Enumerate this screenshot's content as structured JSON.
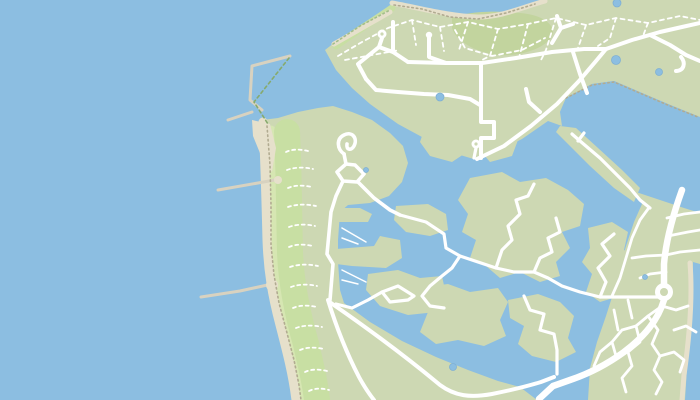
{
  "meta": {
    "kind": "map-tile",
    "description": "Coastal marina map with breakwater harbour, dune beach strip, headland road network and marina island estate",
    "width": 700,
    "height": 400
  },
  "map": {
    "palette": {
      "water": "#8cbee1",
      "pond": "#8cbee1",
      "pondEdge": "#7fb0d4",
      "land": "#cdd8b3",
      "duneLight": "#d6e6b2",
      "duneMid": "#c8dfa3",
      "scrub": "#c2d49e",
      "sand": "#e6e0cb",
      "sandPier": "#d8d2c0",
      "road": "#ffffff",
      "trail": "#ffffff",
      "dotTan": "#b1ab91",
      "dotGreen": "#a3bd8a",
      "dashGreen": "#86aa6d"
    },
    "layers": [
      {
        "name": "sea-base",
        "fill": "water",
        "paths": [
          "M0,0 H700 V400 H0 Z"
        ]
      },
      {
        "name": "headland-land",
        "fill": "land",
        "paths": [
          "M545,0 L700,0 L700,117 L668,104 L642,93 L614,81 L592,84 L566,98 L560,112 L562,126 L548,121 L522,139 L498,151 L477,160 L450,152 L422,137 L398,124 L370,104 L352,88 L336,70 L325,50 L334,43 L362,25 L392,4 L420,7 L450,15 L478,17 L508,11 L535,2 Z"
        ]
      },
      {
        "name": "coastal-strip-land",
        "fill": "land",
        "paths": [
          "M262,120 L278,118 L298,112 L318,108 L333,106 L352,112 L372,120 L390,133 L403,146 L408,163 L402,182 L389,196 L370,203 L348,205 L340,212 L338,240 L338,262 L340,290 L344,303 L370,322 L402,341 L436,357 L468,370 L498,381 L520,387 L537,400 L300,400 L296,372 L288,345 L281,318 L276,294 L272,268 L270,238 L268,200 L266,162 L263,138 Z"
        ]
      },
      {
        "name": "urban-land",
        "fill": "land",
        "paths": [
          "M642,204 L636,192 L660,200 L684,208 L700,213 L700,400 L588,400 L590,368 L597,342 L606,316 L613,294 L619,270 L626,246 L634,222 Z"
        ]
      },
      {
        "name": "dune-band-light",
        "stroke": "duneLight",
        "width": 9,
        "paths": [
          "M271,130 C272,170 272,210 273,250 C274,280 280,310 289,342 C295,365 300,382 302,400"
        ]
      },
      {
        "name": "dune-band-mid",
        "stroke": "duneMid",
        "width": 26,
        "paths": [
          "M287,132 C289,172 289,212 290,252 C291,282 297,312 306,344 C311,366 315,382 317,400"
        ]
      },
      {
        "name": "nw-coast-band",
        "stroke": "duneMid",
        "width": 7,
        "paths": [
          "M336,46 C352,34 372,22 392,8"
        ]
      },
      {
        "name": "scrub-patch",
        "fill": "scrub",
        "paths": [
          "M452,18 C465,12 492,10 520,13 C545,15 556,26 552,36 C546,48 520,57 498,55 C476,53 455,40 452,28 Z"
        ]
      },
      {
        "name": "beach-strokes",
        "stroke": "sand",
        "width": 9,
        "paths": [
          "M263,122 C265,160 266,200 267,240 C268,270 272,295 280,325 C287,352 293,375 296,400"
        ]
      },
      {
        "name": "beach-north",
        "stroke": "sand",
        "width": 5,
        "paths": [
          "M392,3 C420,8 448,16 478,17 C502,17 520,8 545,1",
          "M334,44 L390,12"
        ]
      },
      {
        "name": "beach-harbour",
        "fill": "sand",
        "paths": [
          "M252,120 L270,124 L276,148 L272,172 L262,158 L253,136 Z"
        ]
      },
      {
        "name": "basin-ne-water",
        "fill": "water",
        "paths": [
          "M566,98 L592,84 L614,81 L642,93 L670,105 L700,118 L700,210 L674,201 L650,196 L636,190 L612,176 L585,148 L566,124 L560,112 Z"
        ]
      },
      {
        "name": "east-sea",
        "fill": "water",
        "paths": [
          "M693,262 L700,264 L700,400 L685,400 L688,352 L692,310 Z"
        ]
      },
      {
        "name": "beach-east",
        "stroke": "sand",
        "width": 5,
        "paths": [
          "M690,263 C693,300 689,340 684,375 L682,400"
        ]
      },
      {
        "name": "land-fingers",
        "fill": "land",
        "paths": [
          "M336,208 L360,208 L372,214 L368,222 L336,222 Z",
          "M336,249 L374,246 L380,236 L400,240 L402,258 L386,268 L352,266 L336,264 Z"
        ]
      },
      {
        "name": "marina-islands",
        "fill": "land",
        "paths": [
          "M396,206 L428,204 L446,214 L448,230 L430,236 L406,232 L394,220 Z",
          "M368,274 L398,270 L420,278 L442,276 L446,295 L436,312 L408,315 L380,306 L366,290 Z",
          "M424,130 L454,126 L472,132 L470,150 L452,162 L430,156 L420,142 Z",
          "M480,132 L506,128 L518,140 L512,156 L490,162 L478,148 Z",
          "M470,178 L502,172 L520,182 L546,178 L568,190 L584,204 L580,226 L562,232 L570,248 L556,262 L560,276 L540,282 L520,272 L500,278 L486,266 L470,258 L476,240 L462,232 L468,214 L458,200 Z",
          "M508,300 L538,294 L560,302 L574,316 L568,338 L576,352 L556,362 L532,356 L518,344 L524,326 L510,318 Z",
          "M588,228 L612,222 L628,232 L624,250 L636,258 L630,276 L616,282 L620,296 L600,302 L586,292 L592,274 L582,262 L590,248 Z",
          "M560,126 L576,128 L598,148 L622,170 L640,188 L634,202 L614,188 L590,166 L566,142 L556,132 Z",
          "M416,288 L448,284 L470,292 L498,288 L508,302 L500,320 L506,336 L484,346 L458,340 L436,344 L420,332 L428,312 L414,302 Z"
        ]
      },
      {
        "name": "breakwater-piers",
        "stroke": "sandPier",
        "width": 3,
        "paths": [
          "M290,56 L252,66 L250,100 L262,110",
          "M228,120 L252,112",
          "M218,190 L258,183 L280,179",
          "M201,297 L240,291 L272,284"
        ]
      },
      {
        "name": "pier-root-blobs",
        "fill": "sand",
        "circles": [
          [
            272,
            285,
            6
          ],
          [
            278,
            180,
            4
          ]
        ]
      },
      {
        "name": "marina-jetties",
        "stroke": "road",
        "width": 1.5,
        "paths": [
          "M342,228 L366,242",
          "M342,238 L358,244",
          "M342,270 L366,282",
          "M342,280 L358,284"
        ]
      },
      {
        "name": "embankment-dots-west",
        "stroke": "dotTan",
        "width": 1.6,
        "dash": "1.5 3",
        "paths": [
          "M267,126 L270,165 L271,205 L271,245 L274,275 L279,303 L287,333 L294,360 L299,385 L301,400",
          "M394,5 L422,9 L450,17 L478,19 L506,13 L535,4",
          "M566,98 L592,85 L614,82 L642,94 L670,106 L698,117"
        ]
      },
      {
        "name": "embankment-dots-nw",
        "stroke": "dotGreen",
        "width": 1.6,
        "dash": "1.5 3",
        "paths": [
          "M333,44 L360,26 L390,10"
        ]
      },
      {
        "name": "harbour-dyke-dash",
        "stroke": "dashGreen",
        "width": 1.6,
        "dash": "3 3",
        "paths": [
          "M289,58 L254,102 L268,124"
        ]
      },
      {
        "name": "trail-mesh",
        "stroke": "trail",
        "width": 1.8,
        "dash": "4 4",
        "paths": [
          "M338,56 L362,42 L388,28 L412,20 L440,27 L468,22 L498,29 L528,24 L556,18 L586,25 L616,18 L648,23 L680,16 L700,20",
          "M412,20 L416,45",
          "M440,27 L444,51",
          "M468,22 L459,50",
          "M498,29 L490,56 L480,61",
          "M528,24 L519,58",
          "M556,18 L546,50 L540,62",
          "M586,25 L578,48",
          "M616,18 L610,38 L598,46",
          "M648,23 L643,36",
          "M345,60 L372,55 L400,50",
          "M455,30 L465,48 L492,56 L522,50 L545,38"
        ]
      },
      {
        "name": "dune-trails",
        "stroke": "trail",
        "width": 1.8,
        "dash": "3 3.5",
        "paths": [
          "M286,152 c6,-3 14,-3 22,-1",
          "M287,170 c8,-3 17,-3 26,-1",
          "M288,188 c7,-3 15,-3 24,-1",
          "M288,207 c9,-3 18,-3 28,-1",
          "M289,227 c8,-3 17,-3 26,-1",
          "M289,247 c7,-3 15,-3 24,-1",
          "M290,267 c9,-3 18,-3 28,-1",
          "M291,287 c8,-3 17,-3 26,-1",
          "M293,308 c7,-3 15,-3 24,-1",
          "M296,328 c8,-3 17,-3 26,-1",
          "M300,350 c7,-3 15,-3 24,-1",
          "M305,372 c6,-3 14,-3 22,-1",
          "M309,391 c6,-3 13,-3 20,-1"
        ]
      },
      {
        "name": "urban-streets",
        "stroke": "road",
        "width": 2.8,
        "paths": [
          "M648,209 L640,220 L632,238 L626,258 L620,278 L612,296",
          "M700,250 L680,252 L666,255 L646,256 L632,258",
          "M666,272 L650,274 L640,278",
          "M668,236 L688,232 L700,230",
          "M667,218 L684,214 L700,212",
          "M662,306 L648,316 L636,326 L640,342 L628,352 L632,366 L622,378 L626,392",
          "M648,316 L658,330 L652,344 L660,356 L654,370 L662,382 L656,394",
          "M636,326 L622,330 L612,342 L616,356",
          "M660,356 L674,352 L684,360 L680,372",
          "M674,330 L686,326 L696,332",
          "M662,306 L676,310 L688,306",
          "M612,342 L600,352 L594,366",
          "M614,310 L618,330",
          "M628,300 L632,318"
        ]
      },
      {
        "name": "island-roads",
        "stroke": "road",
        "width": 3.2,
        "paths": [
          "M400,215 L426,222 L444,234 L446,248 L460,256 L478,262 L496,268 L514,272 L534,272 L548,278 L562,286 L580,292 L600,297 L628,297 L658,297",
          "M496,268 L502,250 L512,240 L508,226 L520,214 L516,200 L528,196 L534,184",
          "M534,272 L540,258 L552,252 L548,238 L560,232 L556,218",
          "M600,297 L606,282 L598,268 L610,256 L602,244 L614,234",
          "M524,296 L530,310 L544,314 L540,330 L554,334 L557,350 L557,374",
          "M460,256 L452,268 L442,276 L430,286 L422,296 L430,306 L444,308",
          "M414,296 L398,286 L382,292 L390,302 L408,300 L414,296",
          "M382,292 L368,300 L352,308 L336,304",
          "M572,134 L580,141 L600,158 L618,176 L630,188 L640,200 L650,208",
          "M584,133 L578,141",
          "M476,148 L474,158"
        ]
      },
      {
        "name": "strip-roads",
        "stroke": "road",
        "width": 3.6,
        "paths": [
          "M344,154 C337,149 336,139 344,135 C352,131 358,138 354,146 C351,151 346,150 347,144",
          "M344,154 L346,164",
          "M346,164 L337,172 L343,181 L357,182 L364,174 L355,165 Z",
          "M358,182 L374,198 L390,210 L400,215",
          "M343,181 L336,196 L331,212 L327,254 L333,264 L330,300"
        ]
      },
      {
        "name": "headland-roads",
        "stroke": "road",
        "width": 4,
        "paths": [
          "M477,159 L504,146 L531,126 L557,104 L579,81 L596,61 L606,49",
          "M606,49 L632,40 L660,32 L682,27 L700,23",
          "M650,35 L670,45 L686,55 L700,61",
          "M681,57 C686,63 684,71 676,71",
          "M408,62 L446,63 L482,63 L516,58 L552,52 L584,49 L606,49",
          "M393,22 L393,52 L408,62",
          "M382,38 L379,47 L393,52",
          "M379,47 L358,64 L366,79",
          "M366,79 L376,90 L398,92 L424,94 L448,95 L470,99 L480,105",
          "M481,64 L481,122 L494,122 L494,138 L481,138 L481,158",
          "M429,38 L429,57 L446,63",
          "M573,52 L580,74 L587,93",
          "M552,43 L561,28 L557,16",
          "M561,28 L573,24",
          "M540,112 L529,102 L526,89"
        ]
      },
      {
        "name": "dam-roads",
        "stroke": "road",
        "width": 4,
        "paths": [
          "M331,303 C370,330 410,360 440,385 C455,396 470,398 492,394 C512,390 528,386 541,382 L554,377",
          "M328,300 C336,326 346,352 359,377 C365,388 370,395 374,400"
        ]
      },
      {
        "name": "main-road",
        "stroke": "road",
        "width": 6.5,
        "paths": [
          "M682,190 C673,215 666,240 664,264 L664,284",
          "M664,300 C658,320 645,336 624,352 C606,365 588,374 570,380 L553,386 L539,399"
        ]
      },
      {
        "name": "roundabout-ring",
        "fill": "road",
        "circles": [
          [
            664,
            292,
            9
          ]
        ]
      },
      {
        "name": "roundabout-center",
        "fill": "land",
        "circles": [
          [
            664,
            292,
            4
          ]
        ]
      },
      {
        "name": "turning-circles",
        "fill": "road",
        "circles": [
          [
            382,
            34,
            4.5
          ],
          [
            429,
            35,
            3.2
          ],
          [
            476,
            144,
            4.5
          ]
        ]
      },
      {
        "name": "turning-circle-holes",
        "fill": "land",
        "circles": [
          [
            382,
            34,
            1.6
          ],
          [
            476,
            144,
            1.6
          ]
        ]
      },
      {
        "name": "ponds",
        "fill": "pond",
        "stroke": "pondEdge",
        "width": 0.8,
        "circles": [
          [
            440,
            97,
            4
          ],
          [
            616,
            60,
            4.5
          ],
          [
            659,
            72,
            3.5
          ],
          [
            617,
            3,
            4
          ],
          [
            453,
            367,
            3.5
          ],
          [
            645,
            277,
            2.5
          ],
          [
            366,
            170,
            2.5
          ]
        ]
      }
    ]
  }
}
